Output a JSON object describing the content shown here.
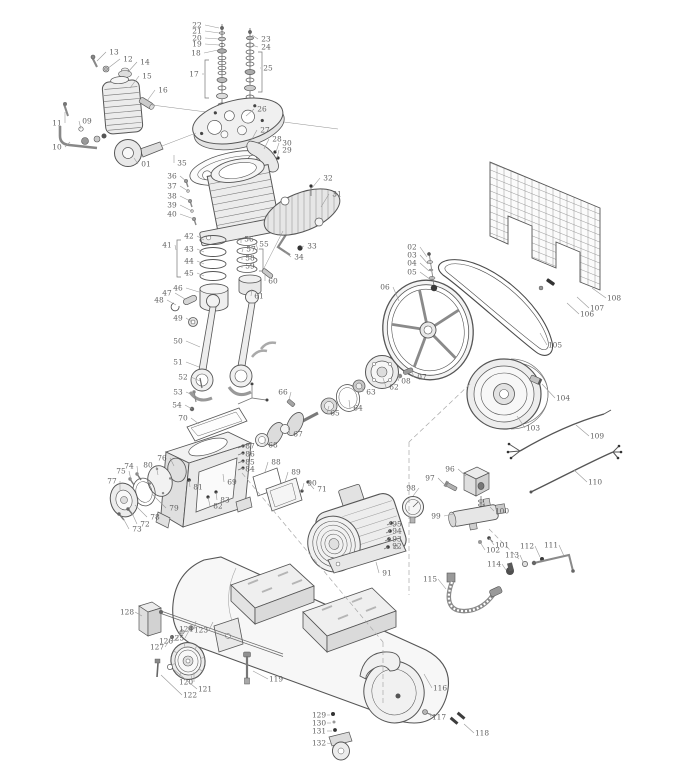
{
  "diagram": {
    "type": "exploded-parts-diagram",
    "part_count": 132,
    "colors": {
      "line": "#4f4f4f",
      "label": "#5f5f5f",
      "leader": "#9a9a9a",
      "background": "#ffffff"
    },
    "labels": [
      {
        "n": "01",
        "x": 146,
        "y": 164,
        "tx": 134,
        "ty": 158
      },
      {
        "n": "02",
        "x": 412,
        "y": 247,
        "tx": 427,
        "ty": 257
      },
      {
        "n": "03",
        "x": 412,
        "y": 255,
        "tx": 428,
        "ty": 264
      },
      {
        "n": "04",
        "x": 412,
        "y": 263,
        "tx": 429,
        "ty": 271
      },
      {
        "n": "05",
        "x": 412,
        "y": 272,
        "tx": 431,
        "ty": 280
      },
      {
        "n": "06",
        "x": 385,
        "y": 287,
        "tx": 399,
        "ty": 301
      },
      {
        "n": "07",
        "x": 422,
        "y": 377,
        "tx": 412,
        "ty": 372
      },
      {
        "n": "08",
        "x": 406,
        "y": 381,
        "tx": 400,
        "ty": 376
      },
      {
        "n": "09",
        "x": 87,
        "y": 121,
        "tx": 81,
        "ty": 129
      },
      {
        "n": "10",
        "x": 57,
        "y": 147,
        "tx": 70,
        "ty": 142
      },
      {
        "n": "11",
        "x": 57,
        "y": 123,
        "tx": 65,
        "ty": 112
      },
      {
        "n": "12",
        "x": 128,
        "y": 59,
        "tx": 107,
        "ty": 69
      },
      {
        "n": "13",
        "x": 114,
        "y": 52,
        "tx": 97,
        "ty": 61
      },
      {
        "n": "14",
        "x": 145,
        "y": 62,
        "tx": 128,
        "ty": 72
      },
      {
        "n": "15",
        "x": 147,
        "y": 76,
        "tx": 130,
        "ty": 88
      },
      {
        "n": "16",
        "x": 163,
        "y": 90,
        "tx": 147,
        "ty": 101
      },
      {
        "n": "17",
        "x": 194,
        "y": 74,
        "tx": 204,
        "ty": 74
      },
      {
        "n": "18",
        "x": 196,
        "y": 53,
        "tx": 218,
        "ty": 50
      },
      {
        "n": "19",
        "x": 197,
        "y": 44,
        "tx": 219,
        "ty": 45
      },
      {
        "n": "20",
        "x": 197,
        "y": 38,
        "tx": 219,
        "ty": 39
      },
      {
        "n": "21",
        "x": 197,
        "y": 31,
        "tx": 219,
        "ty": 33
      },
      {
        "n": "22",
        "x": 197,
        "y": 25,
        "tx": 219,
        "ty": 28
      },
      {
        "n": "23",
        "x": 266,
        "y": 39,
        "tx": 252,
        "ty": 35
      },
      {
        "n": "24",
        "x": 266,
        "y": 47,
        "tx": 252,
        "ty": 45
      },
      {
        "n": "25",
        "x": 268,
        "y": 68,
        "tx": 261,
        "ty": 68
      },
      {
        "n": "26",
        "x": 262,
        "y": 109,
        "tx": 246,
        "ty": 116
      },
      {
        "n": "27",
        "x": 265,
        "y": 130,
        "tx": 252,
        "ty": 139
      },
      {
        "n": "28",
        "x": 277,
        "y": 139,
        "tx": 264,
        "ty": 149
      },
      {
        "n": "29",
        "x": 287,
        "y": 150,
        "tx": 277,
        "ty": 158
      },
      {
        "n": "30",
        "x": 287,
        "y": 143,
        "tx": 276,
        "ty": 152
      },
      {
        "n": "31",
        "x": 337,
        "y": 194,
        "tx": 321,
        "ty": 207
      },
      {
        "n": "32",
        "x": 328,
        "y": 178,
        "tx": 312,
        "ty": 188
      },
      {
        "n": "33",
        "x": 312,
        "y": 246,
        "tx": 301,
        "ty": 247
      },
      {
        "n": "34",
        "x": 299,
        "y": 257,
        "tx": 285,
        "ty": 252
      },
      {
        "n": "35",
        "x": 182,
        "y": 163,
        "tx": 174,
        "ty": 155
      },
      {
        "n": "36",
        "x": 172,
        "y": 176,
        "tx": 186,
        "ty": 181
      },
      {
        "n": "37",
        "x": 172,
        "y": 186,
        "tx": 188,
        "ty": 191
      },
      {
        "n": "38",
        "x": 172,
        "y": 196,
        "tx": 190,
        "ty": 201
      },
      {
        "n": "39",
        "x": 172,
        "y": 205,
        "tx": 192,
        "ty": 211
      },
      {
        "n": "40",
        "x": 172,
        "y": 214,
        "tx": 194,
        "ty": 219
      },
      {
        "n": "41",
        "x": 167,
        "y": 245,
        "tx": 176,
        "ty": 250
      },
      {
        "n": "42",
        "x": 189,
        "y": 236,
        "tx": 204,
        "ty": 240
      },
      {
        "n": "43",
        "x": 189,
        "y": 249,
        "tx": 204,
        "ty": 252
      },
      {
        "n": "44",
        "x": 189,
        "y": 261,
        "tx": 204,
        "ty": 264
      },
      {
        "n": "45",
        "x": 189,
        "y": 273,
        "tx": 204,
        "ty": 276
      },
      {
        "n": "46",
        "x": 178,
        "y": 288,
        "tx": 199,
        "ty": 292
      },
      {
        "n": "47",
        "x": 167,
        "y": 293,
        "tx": 185,
        "ty": 299
      },
      {
        "n": "48",
        "x": 159,
        "y": 300,
        "tx": 176,
        "ty": 305
      },
      {
        "n": "49",
        "x": 178,
        "y": 318,
        "tx": 192,
        "ty": 322
      },
      {
        "n": "50",
        "x": 178,
        "y": 341,
        "tx": 200,
        "ty": 347
      },
      {
        "n": "51",
        "x": 178,
        "y": 362,
        "tx": 199,
        "ty": 367
      },
      {
        "n": "52",
        "x": 183,
        "y": 377,
        "tx": 200,
        "ty": 381
      },
      {
        "n": "53",
        "x": 178,
        "y": 392,
        "tx": 195,
        "ty": 396
      },
      {
        "n": "54",
        "x": 177,
        "y": 405,
        "tx": 192,
        "ty": 409
      },
      {
        "n": "55",
        "x": 264,
        "y": 244,
        "tx": 258,
        "ty": 250
      },
      {
        "n": "56",
        "x": 249,
        "y": 239,
        "tx": 241,
        "ty": 243
      },
      {
        "n": "57",
        "x": 251,
        "y": 249,
        "tx": 242,
        "ty": 252
      },
      {
        "n": "58",
        "x": 250,
        "y": 258,
        "tx": 242,
        "ty": 260
      },
      {
        "n": "59",
        "x": 250,
        "y": 266,
        "tx": 242,
        "ty": 268
      },
      {
        "n": "60",
        "x": 273,
        "y": 281,
        "tx": 265,
        "ty": 275
      },
      {
        "n": "61",
        "x": 259,
        "y": 296,
        "tx": 252,
        "ty": 289
      },
      {
        "n": "62",
        "x": 394,
        "y": 387,
        "tx": 383,
        "ty": 378
      },
      {
        "n": "63",
        "x": 371,
        "y": 392,
        "tx": 361,
        "ty": 384
      },
      {
        "n": "64",
        "x": 358,
        "y": 408,
        "tx": 349,
        "ty": 400
      },
      {
        "n": "65",
        "x": 335,
        "y": 413,
        "tx": 329,
        "ty": 406
      },
      {
        "n": "66",
        "x": 283,
        "y": 392,
        "tx": 289,
        "ty": 400
      },
      {
        "n": "67",
        "x": 298,
        "y": 434,
        "tx": 288,
        "ty": 427
      },
      {
        "n": "68",
        "x": 273,
        "y": 445,
        "tx": 265,
        "ty": 438
      },
      {
        "n": "69",
        "x": 232,
        "y": 482,
        "tx": 223,
        "ty": 474
      },
      {
        "n": "70",
        "x": 183,
        "y": 418,
        "tx": 199,
        "ty": 424
      },
      {
        "n": "71",
        "x": 322,
        "y": 489,
        "tx": 308,
        "ty": 482
      },
      {
        "n": "72",
        "x": 145,
        "y": 524,
        "tx": 132,
        "ty": 513
      },
      {
        "n": "73",
        "x": 137,
        "y": 529,
        "tx": 123,
        "ty": 518
      },
      {
        "n": "74",
        "x": 129,
        "y": 466,
        "tx": 138,
        "ty": 475
      },
      {
        "n": "75",
        "x": 121,
        "y": 471,
        "tx": 131,
        "ty": 480
      },
      {
        "n": "76",
        "x": 162,
        "y": 458,
        "tx": 174,
        "ty": 466
      },
      {
        "n": "77",
        "x": 112,
        "y": 481,
        "tx": 120,
        "ty": 491
      },
      {
        "n": "78",
        "x": 155,
        "y": 517,
        "tx": 135,
        "ty": 505
      },
      {
        "n": "79",
        "x": 174,
        "y": 508,
        "tx": 152,
        "ty": 494
      },
      {
        "n": "80",
        "x": 148,
        "y": 465,
        "tx": 158,
        "ty": 475
      },
      {
        "n": "81",
        "x": 198,
        "y": 487,
        "tx": 189,
        "ty": 480
      },
      {
        "n": "82",
        "x": 218,
        "y": 506,
        "tx": 208,
        "ty": 497
      },
      {
        "n": "83",
        "x": 225,
        "y": 500,
        "tx": 216,
        "ty": 492
      },
      {
        "n": "84",
        "x": 250,
        "y": 469,
        "tx": 244,
        "ty": 468
      },
      {
        "n": "85",
        "x": 250,
        "y": 462,
        "tx": 244,
        "ty": 461
      },
      {
        "n": "86",
        "x": 250,
        "y": 454,
        "tx": 244,
        "ty": 453
      },
      {
        "n": "87",
        "x": 250,
        "y": 446,
        "tx": 244,
        "ty": 446
      },
      {
        "n": "88",
        "x": 276,
        "y": 462,
        "tx": 265,
        "ty": 472
      },
      {
        "n": "89",
        "x": 296,
        "y": 472,
        "tx": 285,
        "ty": 482
      },
      {
        "n": "90",
        "x": 312,
        "y": 483,
        "tx": 302,
        "ty": 491
      },
      {
        "n": "91",
        "x": 387,
        "y": 573,
        "tx": 376,
        "ty": 562
      },
      {
        "n": "92",
        "x": 397,
        "y": 546,
        "tx": 389,
        "ty": 546
      },
      {
        "n": "93",
        "x": 397,
        "y": 539,
        "tx": 390,
        "ty": 538
      },
      {
        "n": "94",
        "x": 397,
        "y": 531,
        "tx": 390,
        "ty": 530
      },
      {
        "n": "95",
        "x": 397,
        "y": 524,
        "tx": 391,
        "ty": 522
      },
      {
        "n": "96",
        "x": 450,
        "y": 469,
        "tx": 466,
        "ty": 476
      },
      {
        "n": "97",
        "x": 430,
        "y": 478,
        "tx": 446,
        "ty": 486
      },
      {
        "n": "98",
        "x": 411,
        "y": 488,
        "tx": 413,
        "ty": 496
      },
      {
        "n": "99",
        "x": 436,
        "y": 516,
        "tx": 453,
        "ty": 514
      },
      {
        "n": "100",
        "x": 502,
        "y": 511,
        "tx": 490,
        "ty": 507
      },
      {
        "n": "101",
        "x": 502,
        "y": 545,
        "tx": 489,
        "ty": 538
      },
      {
        "n": "102",
        "x": 493,
        "y": 550,
        "tx": 480,
        "ty": 542
      },
      {
        "n": "103",
        "x": 533,
        "y": 428,
        "tx": 517,
        "ty": 416
      },
      {
        "n": "104",
        "x": 563,
        "y": 398,
        "tx": 542,
        "ty": 384
      },
      {
        "n": "105",
        "x": 555,
        "y": 345,
        "tx": 540,
        "ty": 333
      },
      {
        "n": "106",
        "x": 587,
        "y": 314,
        "tx": 567,
        "ty": 303
      },
      {
        "n": "107",
        "x": 597,
        "y": 308,
        "tx": 577,
        "ty": 297
      },
      {
        "n": "108",
        "x": 614,
        "y": 298,
        "tx": 592,
        "ty": 288
      },
      {
        "n": "109",
        "x": 597,
        "y": 436,
        "tx": 576,
        "ty": 425
      },
      {
        "n": "110",
        "x": 595,
        "y": 482,
        "tx": 574,
        "ty": 470
      },
      {
        "n": "111",
        "x": 551,
        "y": 545,
        "tx": 564,
        "ty": 556
      },
      {
        "n": "112",
        "x": 527,
        "y": 546,
        "tx": 540,
        "ty": 557
      },
      {
        "n": "113",
        "x": 512,
        "y": 555,
        "tx": 523,
        "ty": 562
      },
      {
        "n": "114",
        "x": 494,
        "y": 564,
        "tx": 506,
        "ty": 570
      },
      {
        "n": "115",
        "x": 430,
        "y": 579,
        "tx": 446,
        "ty": 589
      },
      {
        "n": "116",
        "x": 440,
        "y": 688,
        "tx": 424,
        "ty": 674
      },
      {
        "n": "117",
        "x": 439,
        "y": 717,
        "tx": 430,
        "ty": 713
      },
      {
        "n": "118",
        "x": 482,
        "y": 733,
        "tx": 464,
        "ty": 724
      },
      {
        "n": "119",
        "x": 276,
        "y": 679,
        "tx": 253,
        "ty": 671
      },
      {
        "n": "120",
        "x": 186,
        "y": 682,
        "tx": 194,
        "ty": 672
      },
      {
        "n": "121",
        "x": 205,
        "y": 689,
        "tx": 173,
        "ty": 669
      },
      {
        "n": "122",
        "x": 190,
        "y": 695,
        "tx": 161,
        "ty": 675
      },
      {
        "n": "123",
        "x": 201,
        "y": 630,
        "tx": 213,
        "ty": 622
      },
      {
        "n": "124",
        "x": 186,
        "y": 629,
        "tx": 196,
        "ty": 621
      },
      {
        "n": "125",
        "x": 177,
        "y": 638,
        "tx": 190,
        "ty": 629
      },
      {
        "n": "126",
        "x": 166,
        "y": 641,
        "tx": 181,
        "ty": 633
      },
      {
        "n": "127",
        "x": 157,
        "y": 647,
        "tx": 171,
        "ty": 638
      },
      {
        "n": "128",
        "x": 127,
        "y": 612,
        "tx": 142,
        "ty": 616
      },
      {
        "n": "129",
        "x": 319,
        "y": 715,
        "tx": 330,
        "ty": 715
      },
      {
        "n": "130",
        "x": 319,
        "y": 723,
        "tx": 331,
        "ty": 723
      },
      {
        "n": "131",
        "x": 319,
        "y": 731,
        "tx": 332,
        "ty": 731
      },
      {
        "n": "132",
        "x": 319,
        "y": 743,
        "tx": 331,
        "ty": 744
      }
    ]
  }
}
